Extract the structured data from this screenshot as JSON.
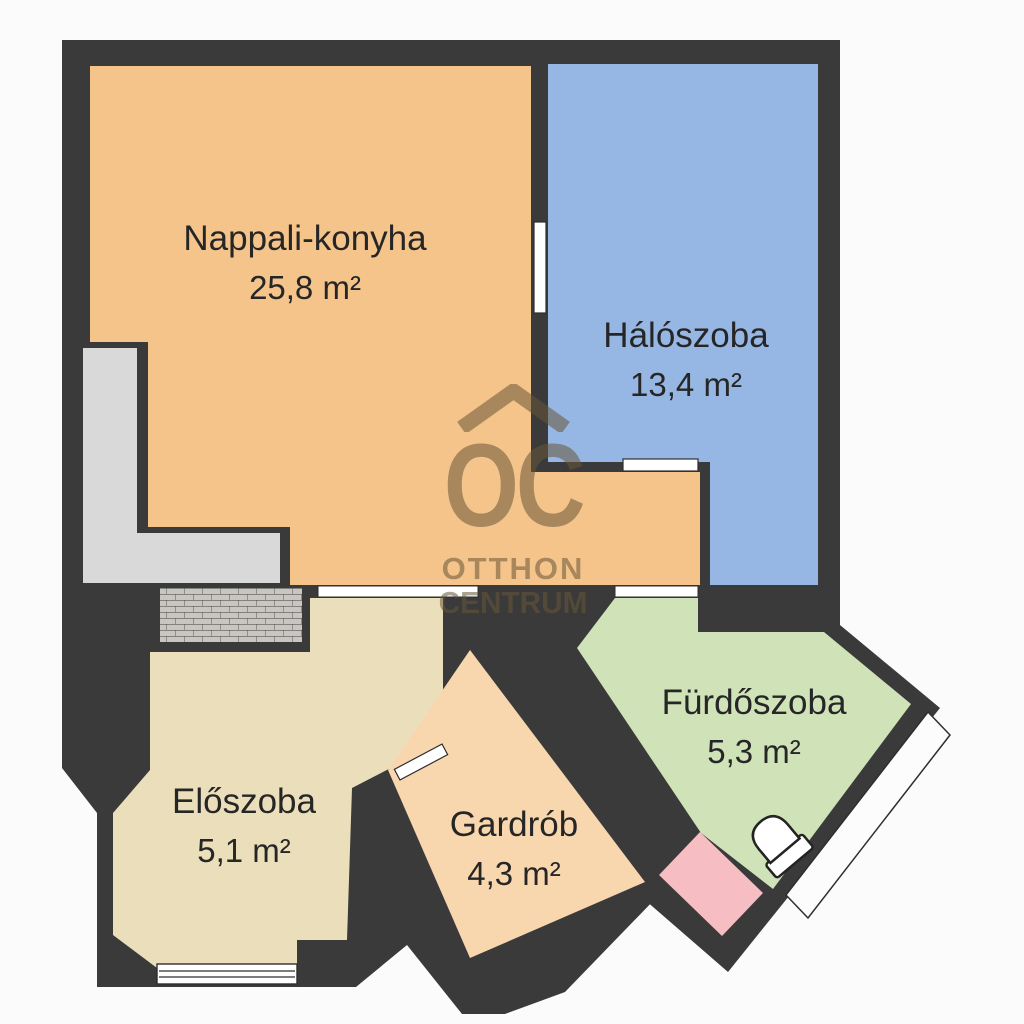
{
  "plan": {
    "title": "Apartment floor plan",
    "watermark": {
      "monogram": "OC",
      "line1": "OTTHON",
      "line2": "CENTRUM"
    },
    "rooms": [
      {
        "name": "Nappali-konyha",
        "area": "25,8 m²",
        "color": "#f5c48b"
      },
      {
        "name": "Hálószoba",
        "area": "13,4 m²",
        "color": "#96b7e4"
      },
      {
        "name": "Fürdőszoba",
        "area": "5,3 m²",
        "color": "#cfe2b8"
      },
      {
        "name": "Előszoba",
        "area": "5,1 m²",
        "color": "#ebdfbb"
      },
      {
        "name": "Gardrób",
        "area": "4,3 m²",
        "color": "#f8d7af"
      }
    ],
    "colors": {
      "wall": "#3a3a3a",
      "background": "#fbfbfb",
      "shaft": "#d9d9d9",
      "tile_base": "#c9c6c2",
      "accent_pink": "#f6bdc2",
      "door": "#ffffff",
      "balcony": "#fcfcfc",
      "fixture": "#ffffff",
      "text": "#262626",
      "watermark": "#68563a"
    }
  }
}
